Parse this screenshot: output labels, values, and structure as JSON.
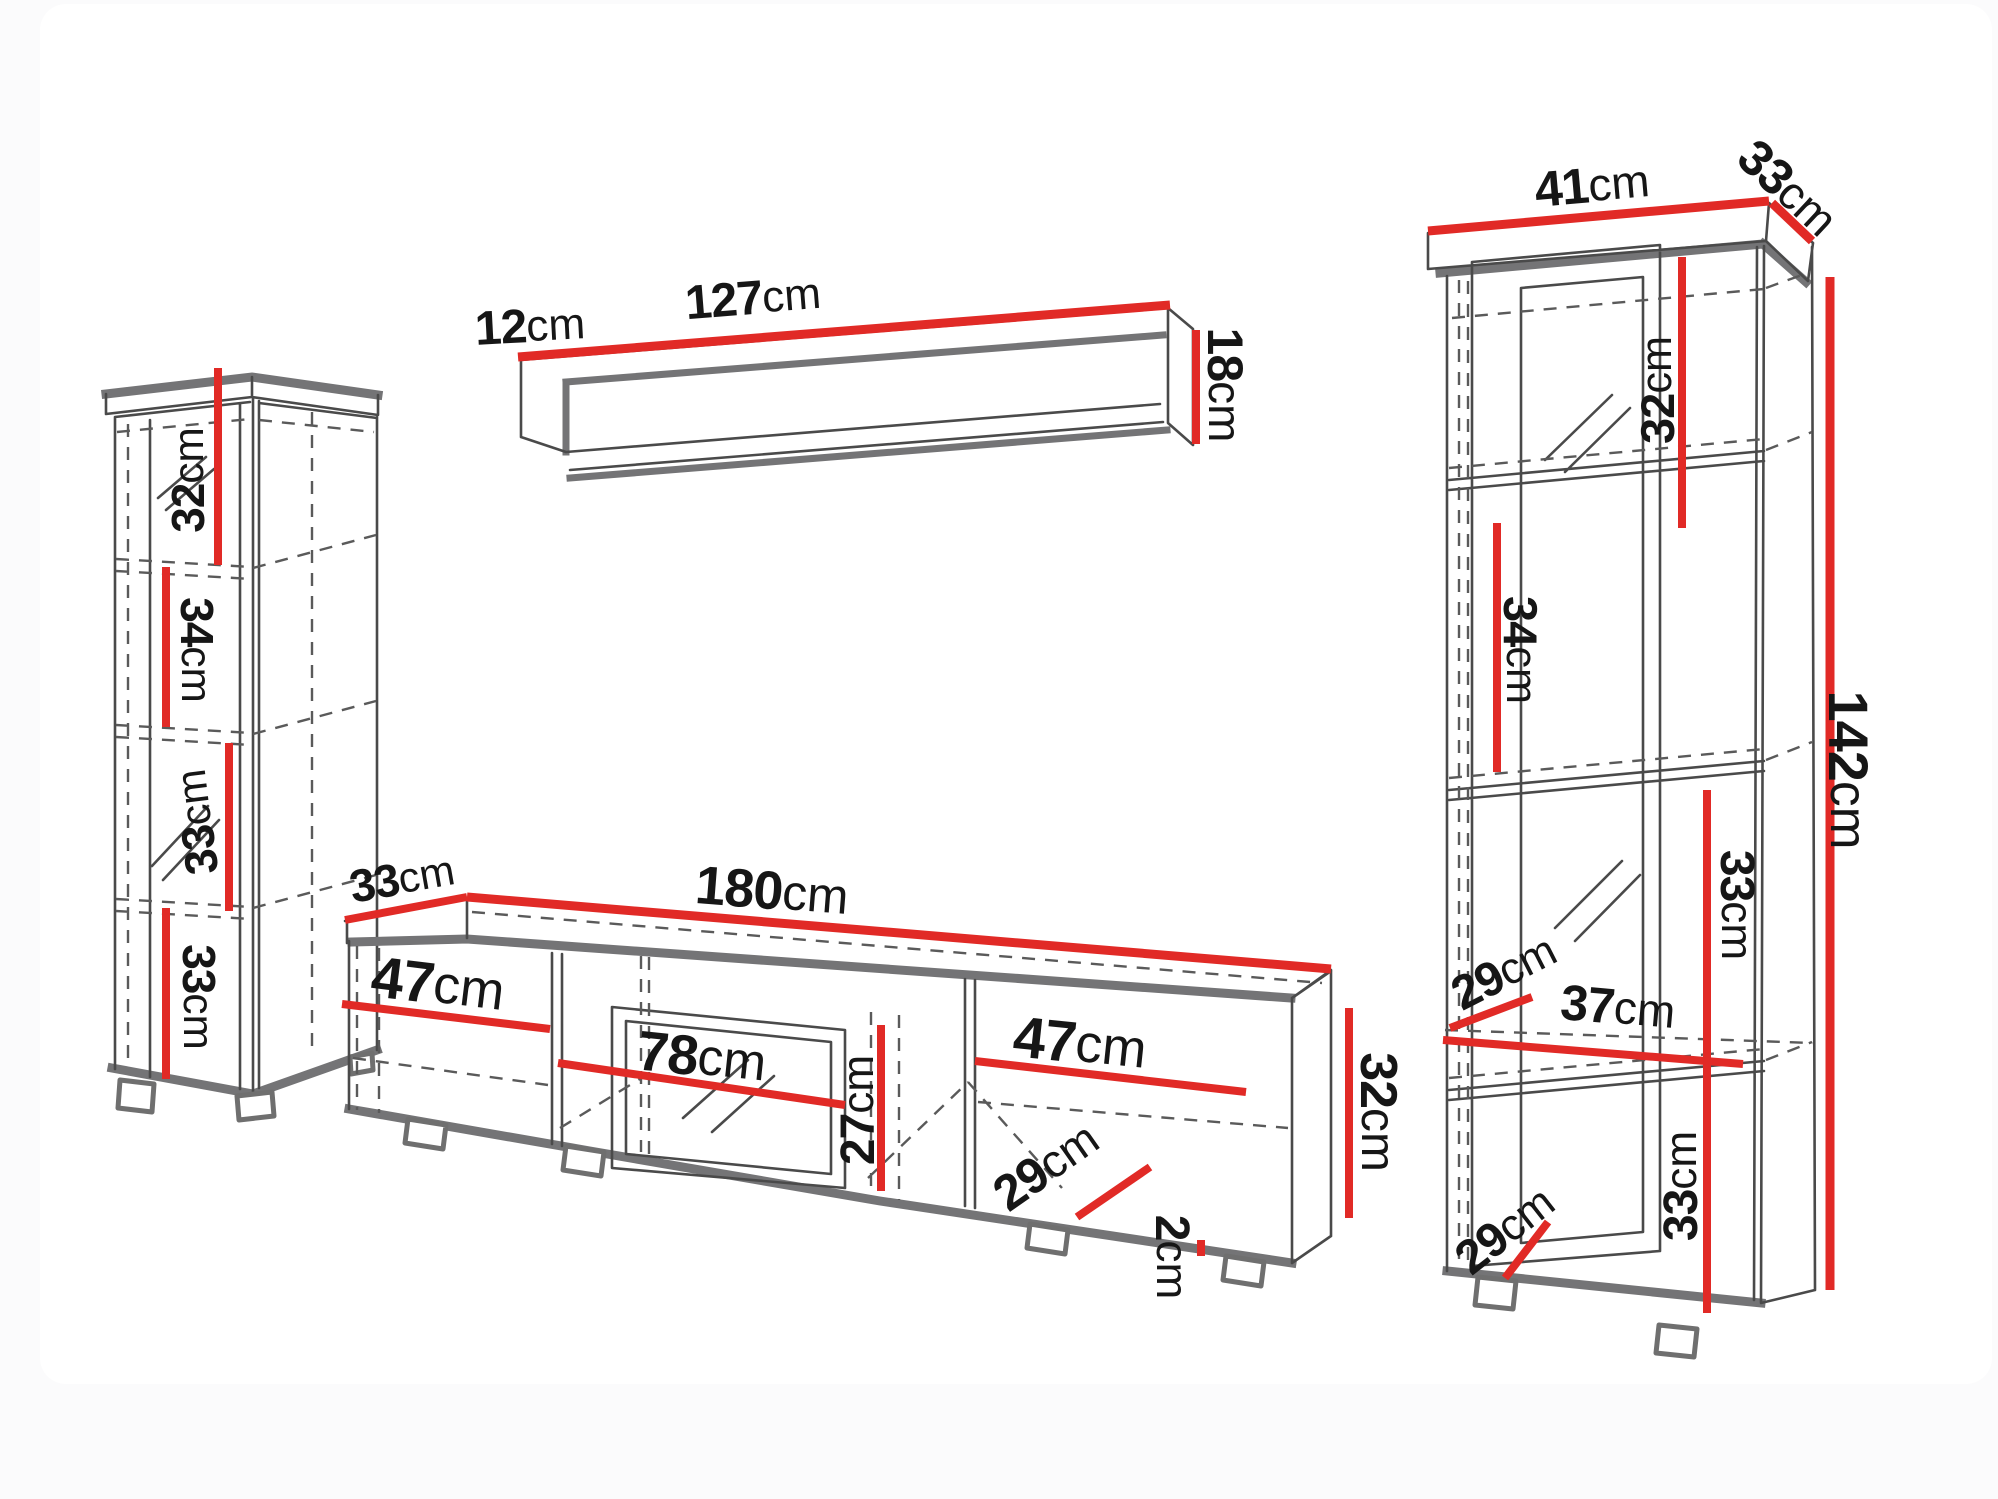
{
  "meta": {
    "type": "furniture dimension diagram",
    "unit": "cm"
  },
  "colors": {
    "dimension_line": "#e12a26",
    "panel_edge": "#747476",
    "outline": "#4a4a4a",
    "hidden_line": "#5a5a5a",
    "label_text": "#161616",
    "background": "#ffffff"
  },
  "pieces": {
    "left_cabinet": {
      "name": "tall cabinet (left)",
      "dims": [
        {
          "v": "32",
          "u": "cm"
        },
        {
          "v": "34",
          "u": "cm"
        },
        {
          "v": "33",
          "u": "cm"
        },
        {
          "v": "33",
          "u": "cm"
        }
      ]
    },
    "wall_shelf": {
      "name": "wall shelf (top)",
      "dims": [
        {
          "v": "12",
          "u": "cm"
        },
        {
          "v": "127",
          "u": "cm"
        },
        {
          "v": "18",
          "u": "cm"
        }
      ]
    },
    "tv_stand": {
      "name": "TV stand (bottom center)",
      "dims": [
        {
          "v": "33",
          "u": "cm"
        },
        {
          "v": "180",
          "u": "cm"
        },
        {
          "v": "47",
          "u": "cm"
        },
        {
          "v": "78",
          "u": "cm"
        },
        {
          "v": "27",
          "u": "cm"
        },
        {
          "v": "47",
          "u": "cm"
        },
        {
          "v": "29",
          "u": "cm"
        },
        {
          "v": "2",
          "u": "cm"
        },
        {
          "v": "32",
          "u": "cm"
        }
      ]
    },
    "right_cabinet": {
      "name": "display cabinet (right)",
      "dims": [
        {
          "v": "41",
          "u": "cm"
        },
        {
          "v": "33",
          "u": "cm"
        },
        {
          "v": "32",
          "u": "cm"
        },
        {
          "v": "34",
          "u": "cm"
        },
        {
          "v": "142",
          "u": "cm"
        },
        {
          "v": "33",
          "u": "cm"
        },
        {
          "v": "29",
          "u": "cm"
        },
        {
          "v": "37",
          "u": "cm"
        },
        {
          "v": "33",
          "u": "cm"
        },
        {
          "v": "29",
          "u": "cm"
        }
      ]
    }
  }
}
